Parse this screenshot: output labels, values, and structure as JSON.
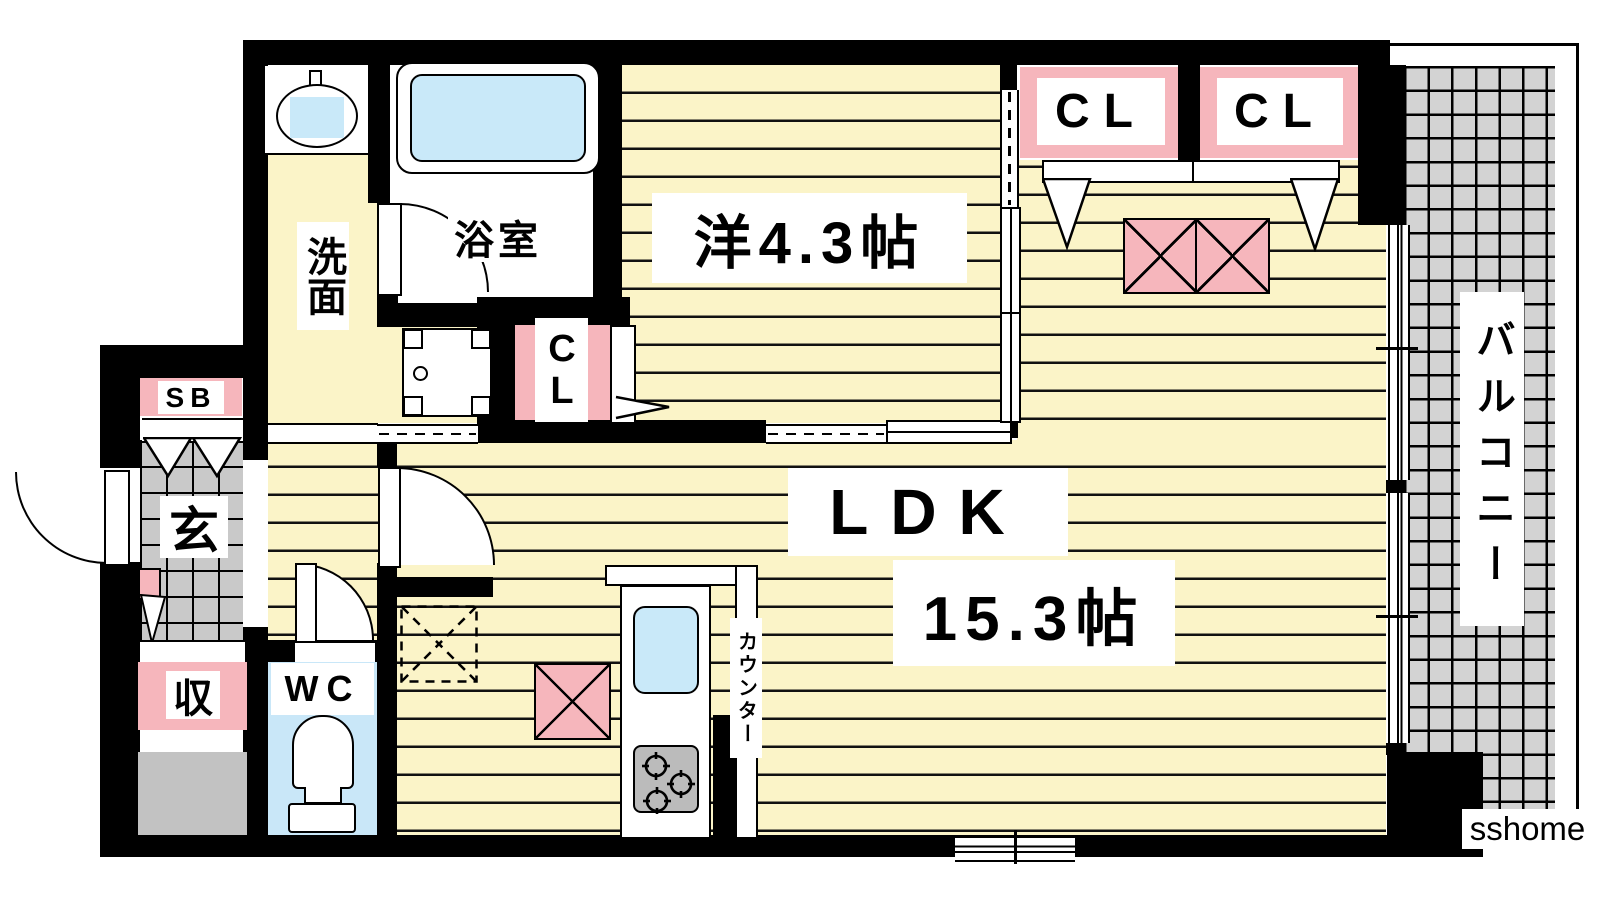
{
  "labels": {
    "bedroom": "洋4.3帖",
    "ldk_name": "LDK",
    "ldk_size": "15.3帖",
    "closet_right_1": "CL",
    "closet_right_2": "CL",
    "closet_small": "CL",
    "bathroom": "浴室",
    "washroom": "洗面",
    "shoe_box": "SB",
    "entrance": "玄",
    "storage": "収",
    "toilet_room": "WC",
    "balcony": "バルコニー",
    "counter": "カウンター",
    "watermark": "sshome"
  },
  "colors": {
    "floor_yellow": "#FBF4C8",
    "accent_pink": "#F6B6BC",
    "water_blue": "#C9E9F9",
    "wc_blue": "#C9E7F8",
    "tile_gray": "#C9C9C9",
    "balcony_gray": "#D3D3D3",
    "equipment_gray": "#C2C2C2",
    "wall_black": "#000000"
  }
}
